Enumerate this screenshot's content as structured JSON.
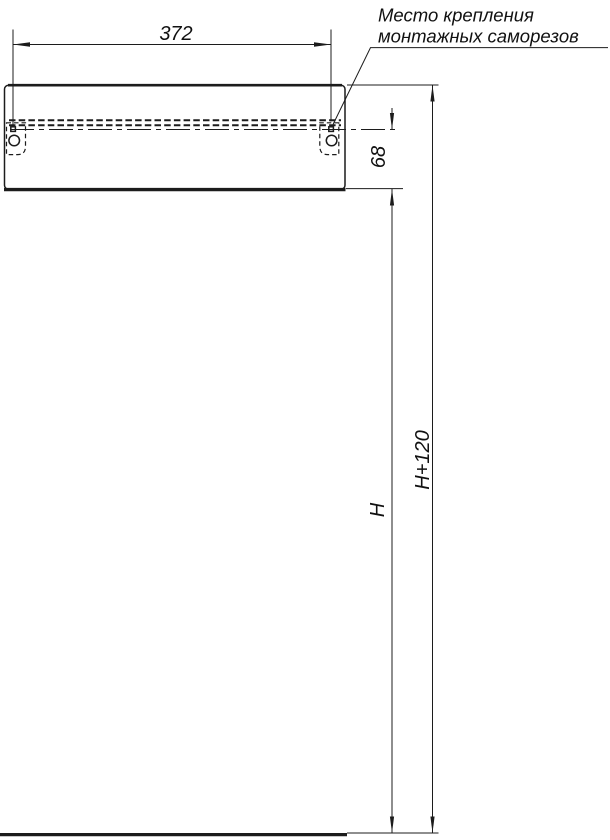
{
  "drawing": {
    "callout": {
      "line1": "Место крепления",
      "line2": "монтажных саморезов"
    },
    "dimensions": {
      "width": "372",
      "rail_to_bottom": "68",
      "height": "H",
      "height_plus": "H+120"
    },
    "colors": {
      "line": "#1c1c1c",
      "text": "#111111",
      "background": "#ffffff"
    }
  }
}
